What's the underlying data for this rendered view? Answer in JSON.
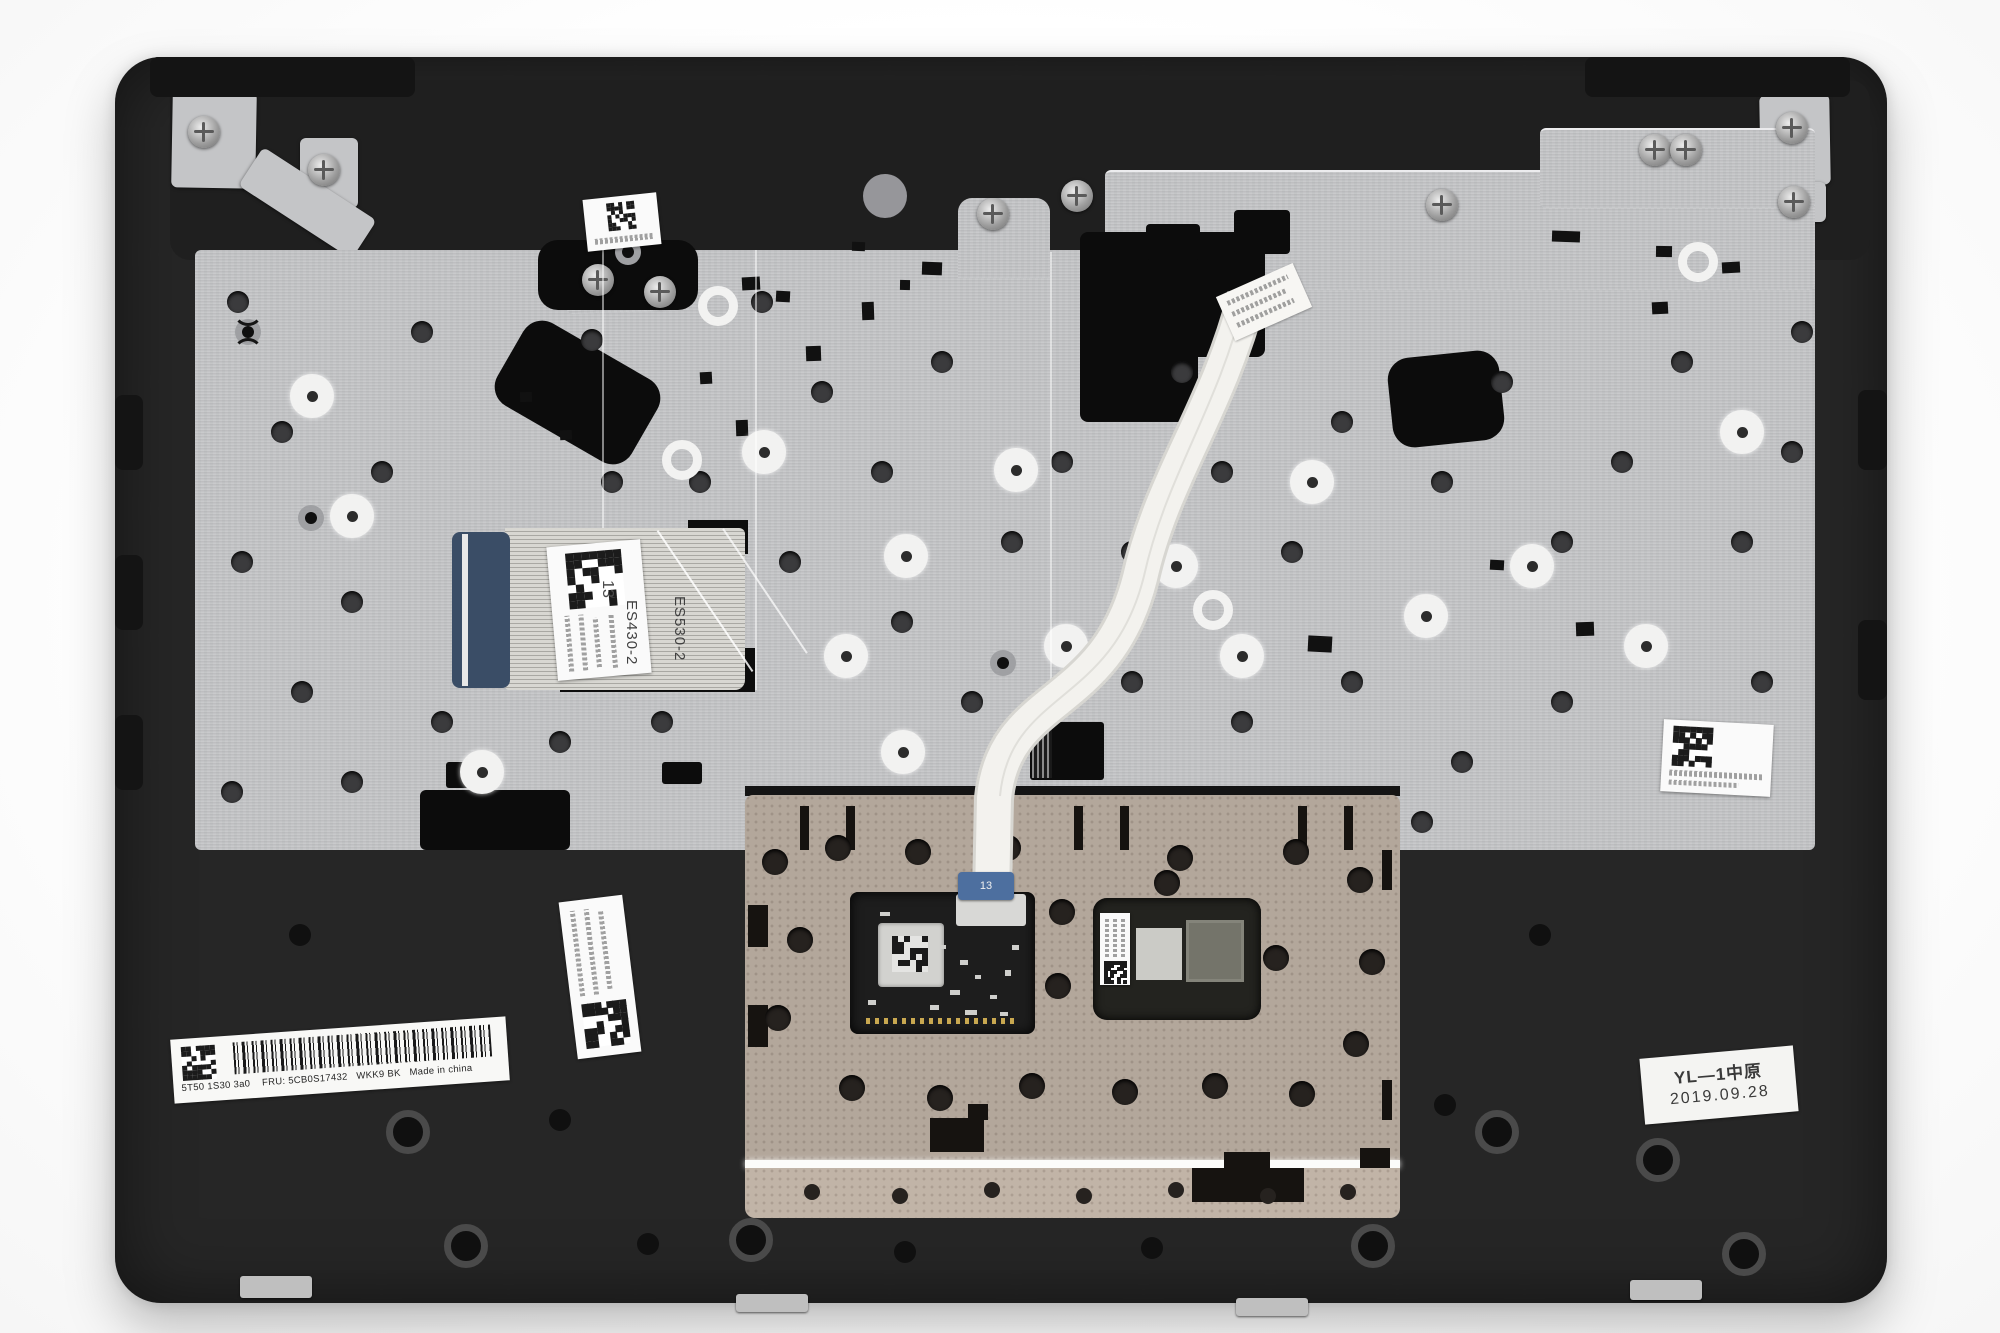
{
  "photo": {
    "subject": "laptop-palmrest-assembly-underside",
    "background_color": "#ffffff"
  },
  "colors": {
    "palmrest_plastic": "#262626",
    "keyboard_plate": "#c5c6c8",
    "touchpad_bracket": "#b3a79b",
    "touchpad_pcb": "#1d1d1d",
    "ribbon_cable_white": "#f3f2ee",
    "cable_stiffener_blue": "#3a4d66",
    "label_white": "#fafafa",
    "barcode_ink": "#191919"
  },
  "labels": {
    "part_label": {
      "serial": "5T50 1S30 3a0",
      "fru": "FRU: 5CB0S17432",
      "model_code": "WKK9 BK",
      "origin": "Made in china"
    },
    "qc_stamp": {
      "line1": "YL—1中原",
      "line2": "2019.09.28"
    },
    "keyboard_cable_markings": {
      "m1": "ES430-2",
      "m2": "ES530-2",
      "m3": "13"
    },
    "touchpad_cable_marking": "13"
  },
  "icons": {
    "qr": "qr-code",
    "datamatrix": "data-matrix-code",
    "barcode": "linear-barcode"
  }
}
